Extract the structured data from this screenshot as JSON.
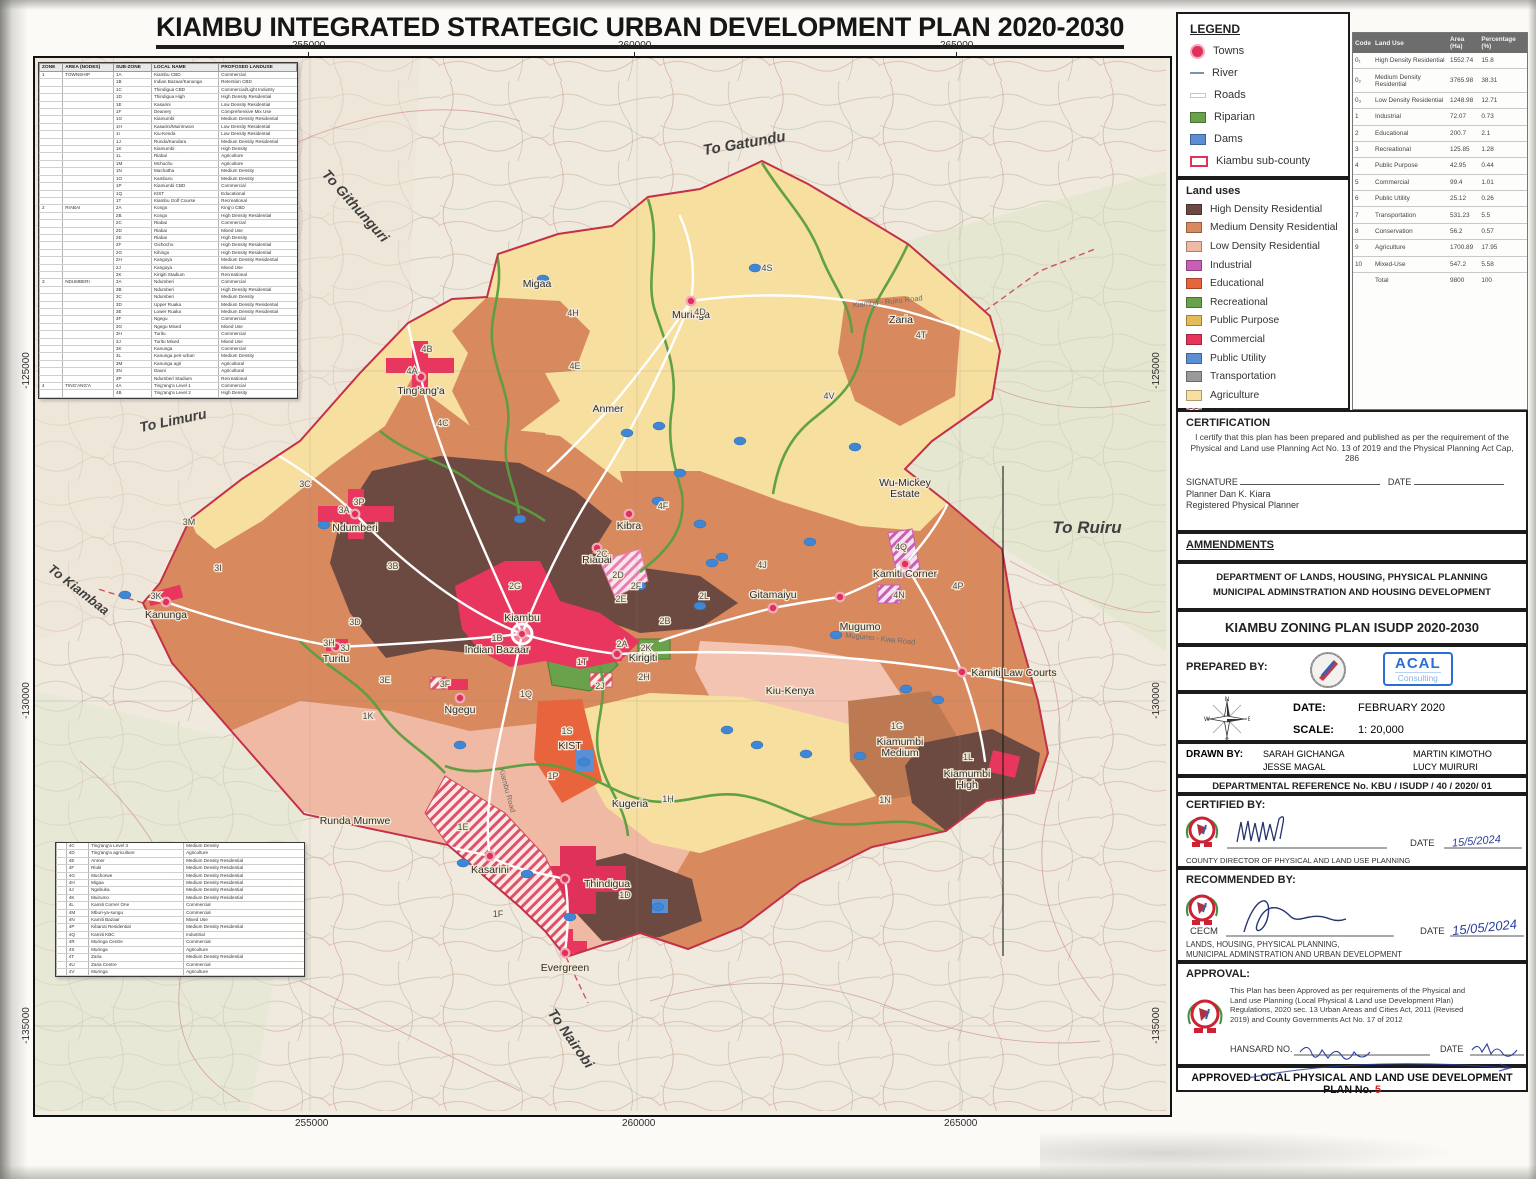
{
  "title": "KIAMBU INTEGRATED STRATEGIC URBAN DEVELOPMENT PLAN 2020-2030",
  "coordinates": {
    "top": [
      "255000",
      "260000",
      "265000"
    ],
    "bottom": [
      "255000",
      "260000",
      "265000"
    ],
    "left": [
      "-125000",
      "-130000",
      "-135000"
    ],
    "right": [
      "-125000",
      "-130000",
      "-135000"
    ]
  },
  "legend": {
    "heading": "LEGEND",
    "items": [
      {
        "label": "Towns",
        "sym": "town"
      },
      {
        "label": "River",
        "sym": "river"
      },
      {
        "label": "Roads",
        "sym": "road"
      },
      {
        "label": "Riparian",
        "sym": "fill",
        "color": "#69a24a"
      },
      {
        "label": "Dams",
        "sym": "fill",
        "color": "#5b8fd4"
      },
      {
        "label": "Kiambu sub-county",
        "sym": "subcounty"
      }
    ],
    "landuse_heading": "Land uses",
    "landuse_items": [
      {
        "label": "High Density Residential",
        "color": "#6d4a41"
      },
      {
        "label": "Medium Density Residential",
        "color": "#d8895e"
      },
      {
        "label": "Low Density Residential",
        "color": "#f0b9a4"
      },
      {
        "label": "Industrial",
        "color": "#c95fb5"
      },
      {
        "label": "Educational",
        "color": "#e8643c"
      },
      {
        "label": "Recreational",
        "color": "#69a24a"
      },
      {
        "label": "Public Purpose",
        "color": "#e3bb57"
      },
      {
        "label": "Commercial",
        "color": "#e73458"
      },
      {
        "label": "Public Utility",
        "color": "#5b8fd4"
      },
      {
        "label": "Transportation",
        "color": "#9a9a9a"
      },
      {
        "label": "Agriculture",
        "color": "#f6df9f"
      },
      {
        "label": "Mixed Use",
        "hatch": true
      }
    ]
  },
  "stats": {
    "headers": [
      "Code",
      "Land Use",
      "Area (Ha)",
      "Percentage (%)"
    ],
    "rows": [
      [
        "0₁",
        "High Density Residential",
        "1552.74",
        "15.8"
      ],
      [
        "0₂",
        "Medium Density Residential",
        "3765.98",
        "38.31"
      ],
      [
        "0₃",
        "Low Density Residential",
        "1248.98",
        "12.71"
      ],
      [
        "1",
        "Industrial",
        "72.07",
        "0.73"
      ],
      [
        "2",
        "Educational",
        "200.7",
        "2.1"
      ],
      [
        "3",
        "Recreational",
        "125.85",
        "1.28"
      ],
      [
        "4",
        "Public Purpose",
        "42.95",
        "0.44"
      ],
      [
        "5",
        "Commercial",
        "99.4",
        "1.01"
      ],
      [
        "6",
        "Public Utility",
        "25.12",
        "0.26"
      ],
      [
        "7",
        "Transportation",
        "531.23",
        "5.5"
      ],
      [
        "8",
        "Conservation",
        "56.2",
        "0.57"
      ],
      [
        "9",
        "Agriculture",
        "1700.89",
        "17.95"
      ],
      [
        "10",
        "Mixed-Use",
        "547.2",
        "5.58"
      ],
      [
        "",
        "Total",
        "9800",
        "100"
      ]
    ]
  },
  "certification": {
    "heading": "CERTIFICATION",
    "body": "I certify that this plan has been prepared and published as per the requirement of the Physical and Land use Planning Act No. 13 of 2019 and the Physical Planning Act Cap, 286",
    "signature_label": "SIGNATURE",
    "date_label": "DATE",
    "name": "Planner Dan K. Kiara",
    "title": "Registered Physical Planner"
  },
  "panel": {
    "amendments": "AMMENDMENTS",
    "dept1": "DEPARTMENT OF LANDS, HOUSING, PHYSICAL PLANNING",
    "dept2": "MUNICIPAL ADMINSTRATION AND HOUSING DEVELOPMENT",
    "zoning_title": "KIAMBU ZONING PLAN ISUDP 2020-2030",
    "prepared_by": "PREPARED BY:",
    "acal_name": "ACAL",
    "acal_sub": "Consulting",
    "date_label": "DATE:",
    "date_value": "FEBRUARY 2020",
    "scale_label": "SCALE:",
    "scale_value": "1: 20,000",
    "drawn_by": "DRAWN BY:",
    "drawn_names": [
      "SARAH GICHANGA",
      "JESSE MAGAL",
      "MARTIN KIMOTHO",
      "LUCY MUIRURI"
    ],
    "dept_ref": "DEPARTMENTAL REFERENCE No. KBU / ISUDP / 40 / 2020/ 01",
    "certified_by": "CERTIFIED BY:",
    "certified_date": "15/5/2024",
    "certified_title": "COUNTY DIRECTOR OF PHYSICAL AND LAND USE PLANNING",
    "recommended_by": "RECOMMENDED BY:",
    "cecm": "CECM",
    "recommended_date": "15/05/2024",
    "rec_dept1": "LANDS, HOUSING, PHYSICAL PLANNING,",
    "rec_dept2": "MUNICIPAL ADMINSTRATION AND URBAN DEVELOPMENT",
    "approval": "APPROVAL:",
    "approval_body": "This Plan has been Approved as per requirements of the Physical and Land use Planning (Local Physical & Land use Development Plan) Regulations, 2020 sec. 13 Urban Areas and Cities Act, 2011 (Revised 2019) and County Governments Act No. 17 of 2012",
    "hansard_label": "HANSARD NO.",
    "approval_date_label": "DATE",
    "approved_bar": "APPROVED LOCAL PHYSICAL AND LAND USE DEVELOPMENT PLAN No.",
    "plan_no": "5"
  },
  "zone_table": {
    "headers": [
      "ZONE",
      "AREA (NODES)",
      "SUB-ZONE",
      "LOCAL NAME",
      "PROPOSED LANDUSE"
    ],
    "top_groups": [
      {
        "zone": "1",
        "area": "TOWNSHIP",
        "rows": [
          [
            "1A",
            "Kiambu CBD",
            "Commercial"
          ],
          [
            "1B",
            "Indian Bazaar/Kanunga",
            "Retention CBD"
          ],
          [
            "1C",
            "Thindigua CBD",
            "Commercial/Light Industry"
          ],
          [
            "1D",
            "Thindigua High",
            "High Density Residential"
          ],
          [
            "1E",
            "Kasarini",
            "Low Density Residential"
          ],
          [
            "1F",
            "Deanery",
            "Comprehensive Mix Use"
          ],
          [
            "1G",
            "Kiamumbi",
            "Medium Density Residential"
          ],
          [
            "1H",
            "Kasarini/Muirimwon",
            "Low Density Residential"
          ],
          [
            "1I",
            "Kiu-Kenda",
            "Low Density Residential"
          ],
          [
            "1J",
            "Runda/Kandara",
            "Medium Density Residential"
          ],
          [
            "1K",
            "Kiamumbi",
            "High Density"
          ],
          [
            "1L",
            "Riabai",
            "Agriculture"
          ],
          [
            "1M",
            "Mchuchu",
            "Agriculture"
          ],
          [
            "1N",
            "Muchatha",
            "Medium Density"
          ],
          [
            "1O",
            "Kamburu",
            "Medium Density"
          ],
          [
            "1P",
            "Kiamumbi CBD",
            "Commercial"
          ],
          [
            "1Q",
            "KIST",
            "Educational"
          ],
          [
            "1T",
            "Kiambu Golf Course",
            "Recreational"
          ]
        ]
      },
      {
        "zone": "2",
        "area": "RIABAI",
        "rows": [
          [
            "2A",
            "Kongo",
            "King'o CBD"
          ],
          [
            "2B",
            "Kongo",
            "High Density Residential"
          ],
          [
            "2C",
            "Riabai",
            "Commercial"
          ],
          [
            "2D",
            "Riabai",
            "Mixed Use"
          ],
          [
            "2E",
            "Riabai",
            "High Density"
          ],
          [
            "2F",
            "Gichocho",
            "High Density Residential"
          ],
          [
            "2G",
            "Kihingo",
            "High Density Residential"
          ],
          [
            "2H",
            "Kangoya",
            "Medium Density Residential"
          ],
          [
            "2J",
            "Kangoya",
            "Mixed Use"
          ],
          [
            "2K",
            "Kirigiti Stadium",
            "Recreational"
          ]
        ]
      },
      {
        "zone": "3",
        "area": "NDUMBERI",
        "rows": [
          [
            "3A",
            "Ndumberi",
            "Commercial"
          ],
          [
            "3B",
            "Ndumberi",
            "High Density Residential"
          ],
          [
            "3C",
            "Ndumberi",
            "Medium Density"
          ],
          [
            "3D",
            "Upper Ruaka",
            "Medium Density Residential"
          ],
          [
            "3E",
            "Lower Ruaka",
            "Medium Density Residential"
          ],
          [
            "3F",
            "Ngegu",
            "Commercial"
          ],
          [
            "3G",
            "Ngegu Mixed",
            "Mixed Use"
          ],
          [
            "3H",
            "Turitu",
            "Commercial"
          ],
          [
            "3J",
            "Turitu Mixed",
            "Mixed Use"
          ],
          [
            "3K",
            "Kanunga",
            "Commercial"
          ],
          [
            "3L",
            "Kanunga peri-urban",
            "Medium Density"
          ],
          [
            "3M",
            "Kanunga agri",
            "Agricultural"
          ],
          [
            "3N",
            "Dauni",
            "Agricultural"
          ],
          [
            "3P",
            "Ndumberi Stadium",
            "Recreational"
          ]
        ]
      },
      {
        "zone": "4",
        "area": "TING'ANG'A",
        "rows": [
          [
            "4A",
            "Ting'ang'a Level 1",
            "Commercial"
          ],
          [
            "4B",
            "Ting'ang'a Level 2",
            "High Density"
          ]
        ]
      }
    ],
    "bottom_rows": [
      [
        "4C",
        "Ting'ang'a Level 3",
        "Medium Density"
      ],
      [
        "4D",
        "Ting'ang'a agriculture",
        "Agriculture"
      ],
      [
        "4E",
        "Anmer",
        "Medium Density Residential"
      ],
      [
        "4F",
        "Riuki",
        "Medium Density Residential"
      ],
      [
        "4G",
        "Muchorwe",
        "Medium Density Residential"
      ],
      [
        "4H",
        "Migaa",
        "Medium Density Residential"
      ],
      [
        "4J",
        "Ngebuka",
        "Medium Density Residential"
      ],
      [
        "4K",
        "Muirumo",
        "Medium Density Residential"
      ],
      [
        "4L",
        "Kamiti Corner One",
        "Commercial"
      ],
      [
        "4M",
        "Mburi-ya-sungu",
        "Commercial"
      ],
      [
        "4N",
        "Kamiti Bazaar",
        "Mixed Use"
      ],
      [
        "4P",
        "Kibaruti Residential",
        "Medium Density Residential"
      ],
      [
        "4Q",
        "Kamiti KBC",
        "Industrial"
      ],
      [
        "4R",
        "Muringa Centre",
        "Commercial"
      ],
      [
        "4S",
        "Muringa",
        "Agriculture"
      ],
      [
        "4T",
        "Zaria",
        "Medium Density Residential"
      ],
      [
        "4U",
        "Zaria Centre",
        "Commercial"
      ],
      [
        "4V",
        "Muringa",
        "Agriculture"
      ]
    ]
  },
  "map": {
    "towns": [
      {
        "name": "Muringa",
        "x": 691,
        "y": 300,
        "dy": 17
      },
      {
        "name": "Ting'ang'a",
        "x": 421,
        "y": 376,
        "dy": 17
      },
      {
        "name": "Kibra",
        "x": 629,
        "y": 513,
        "dy": 15
      },
      {
        "name": "Ndumberi",
        "x": 355,
        "y": 513,
        "dy": 17
      },
      {
        "name": "Riabai",
        "x": 597,
        "y": 547,
        "dy": 15
      },
      {
        "name": "Kiambu",
        "x": 522,
        "y": 633,
        "dy": -13,
        "big": true
      },
      {
        "name": "Kanunga",
        "x": 166,
        "y": 601,
        "dy": 16
      },
      {
        "name": "Turitu",
        "x": 336,
        "y": 646,
        "dy": 15
      },
      {
        "name": "Ngegu",
        "x": 460,
        "y": 697,
        "dy": 15
      },
      {
        "name": "Kirigiti",
        "x": 617,
        "y": 653,
        "dx": 26,
        "dy": 7
      },
      {
        "name": "Gitamaiyu",
        "x": 773,
        "y": 607,
        "dy": -10
      },
      {
        "name": "Mugumo",
        "x": 840,
        "y": 596,
        "dx": 20,
        "dy": 33
      },
      {
        "name": "Kamiti Corner",
        "x": 905,
        "y": 563,
        "dy": 13
      },
      {
        "name": "Kamiti Law Courts",
        "x": 962,
        "y": 671,
        "dx": 52,
        "dy": 4
      },
      {
        "name": "Kasarini",
        "x": 490,
        "y": 855,
        "dy": 17
      },
      {
        "name": "Thindigua",
        "x": 565,
        "y": 878,
        "dx": 42,
        "dy": 8
      },
      {
        "name": "Evergreen",
        "x": 565,
        "y": 952,
        "dy": 18
      }
    ],
    "labels": [
      {
        "text": "Migaa",
        "x": 537,
        "y": 286
      },
      {
        "text": "Zaria",
        "x": 901,
        "y": 322
      },
      {
        "text": "Anmer",
        "x": 608,
        "y": 411
      },
      {
        "text": "Wu-Mickey",
        "line2": "Estate",
        "x": 905,
        "y": 485
      },
      {
        "text": "Indian Bazaar",
        "x": 497,
        "y": 652
      },
      {
        "text": "Kiu-Kenya",
        "x": 790,
        "y": 693
      },
      {
        "text": "Kiamumbi",
        "line2": "Medium",
        "x": 900,
        "y": 744
      },
      {
        "text": "Kiamumbi",
        "line2": "High",
        "x": 967,
        "y": 776
      },
      {
        "text": "KIST",
        "x": 570,
        "y": 748
      },
      {
        "text": "Kugeria",
        "x": 630,
        "y": 806
      },
      {
        "text": "Runda Mumwe",
        "x": 355,
        "y": 823
      }
    ],
    "codes": [
      {
        "c": "4B",
        "x": 427,
        "y": 351
      },
      {
        "c": "4A",
        "x": 412,
        "y": 373
      },
      {
        "c": "4C",
        "x": 443,
        "y": 425
      },
      {
        "c": "4H",
        "x": 573,
        "y": 315
      },
      {
        "c": "4E",
        "x": 575,
        "y": 368
      },
      {
        "c": "4D",
        "x": 700,
        "y": 314
      },
      {
        "c": "4F",
        "x": 663,
        "y": 508
      },
      {
        "c": "4J",
        "x": 762,
        "y": 567
      },
      {
        "c": "4T",
        "x": 921,
        "y": 337
      },
      {
        "c": "4S",
        "x": 767,
        "y": 270
      },
      {
        "c": "4V",
        "x": 829,
        "y": 398
      },
      {
        "c": "4Q",
        "x": 901,
        "y": 549
      },
      {
        "c": "4N",
        "x": 899,
        "y": 597
      },
      {
        "c": "4P",
        "x": 958,
        "y": 588
      },
      {
        "c": "3M",
        "x": 189,
        "y": 524
      },
      {
        "c": "3C",
        "x": 305,
        "y": 486
      },
      {
        "c": "3P",
        "x": 359,
        "y": 504
      },
      {
        "c": "3A",
        "x": 344,
        "y": 512
      },
      {
        "c": "3B",
        "x": 393,
        "y": 568
      },
      {
        "c": "3I",
        "x": 218,
        "y": 570
      },
      {
        "c": "3K",
        "x": 156,
        "y": 598
      },
      {
        "c": "3D",
        "x": 355,
        "y": 624
      },
      {
        "c": "3H",
        "x": 329,
        "y": 645
      },
      {
        "c": "3J",
        "x": 345,
        "y": 650
      },
      {
        "c": "3E",
        "x": 385,
        "y": 682
      },
      {
        "c": "3F",
        "x": 445,
        "y": 686
      },
      {
        "c": "2G",
        "x": 515,
        "y": 588
      },
      {
        "c": "2C",
        "x": 602,
        "y": 556
      },
      {
        "c": "2D",
        "x": 618,
        "y": 577
      },
      {
        "c": "2F",
        "x": 636,
        "y": 588
      },
      {
        "c": "2E",
        "x": 621,
        "y": 601
      },
      {
        "c": "2L",
        "x": 704,
        "y": 598
      },
      {
        "c": "2B",
        "x": 665,
        "y": 623
      },
      {
        "c": "2A",
        "x": 622,
        "y": 646
      },
      {
        "c": "2K",
        "x": 646,
        "y": 650
      },
      {
        "c": "2H",
        "x": 644,
        "y": 679
      },
      {
        "c": "2J",
        "x": 600,
        "y": 688
      },
      {
        "c": "1B",
        "x": 497,
        "y": 640
      },
      {
        "c": "1T",
        "x": 582,
        "y": 664
      },
      {
        "c": "1Q",
        "x": 526,
        "y": 696
      },
      {
        "c": "1S",
        "x": 567,
        "y": 733
      },
      {
        "c": "1K",
        "x": 368,
        "y": 718
      },
      {
        "c": "1P",
        "x": 553,
        "y": 778
      },
      {
        "c": "1G",
        "x": 897,
        "y": 728
      },
      {
        "c": "1L",
        "x": 968,
        "y": 759
      },
      {
        "c": "1N",
        "x": 885,
        "y": 802
      },
      {
        "c": "1H",
        "x": 668,
        "y": 801
      },
      {
        "c": "1D",
        "x": 625,
        "y": 897
      },
      {
        "c": "1E",
        "x": 463,
        "y": 829
      },
      {
        "c": "1F",
        "x": 498,
        "y": 916
      }
    ],
    "dir_labels": [
      {
        "text": "To Gatundu",
        "x": 745,
        "y": 147,
        "a": -10,
        "s": 15
      },
      {
        "text": "To Githunguri",
        "x": 352,
        "y": 208,
        "a": 48,
        "s": 14
      },
      {
        "text": "To Limuru",
        "x": 174,
        "y": 424,
        "a": -12,
        "s": 14
      },
      {
        "text": "To Kiambaa",
        "x": 76,
        "y": 592,
        "a": 38,
        "s": 13
      },
      {
        "text": "To Ruiru",
        "x": 1087,
        "y": 532,
        "a": 0,
        "s": 17
      },
      {
        "text": "To Nairobi",
        "x": 567,
        "y": 1040,
        "a": 55,
        "s": 14
      }
    ],
    "road_labels": [
      {
        "text": "Kiambu - Ruiru Road",
        "x": 888,
        "y": 303,
        "a": -6
      },
      {
        "text": "Kiambu Road",
        "x": 505,
        "y": 790,
        "a": 75
      },
      {
        "text": "Mugumo - Kwa Road",
        "x": 880,
        "y": 640,
        "a": 6
      }
    ]
  }
}
